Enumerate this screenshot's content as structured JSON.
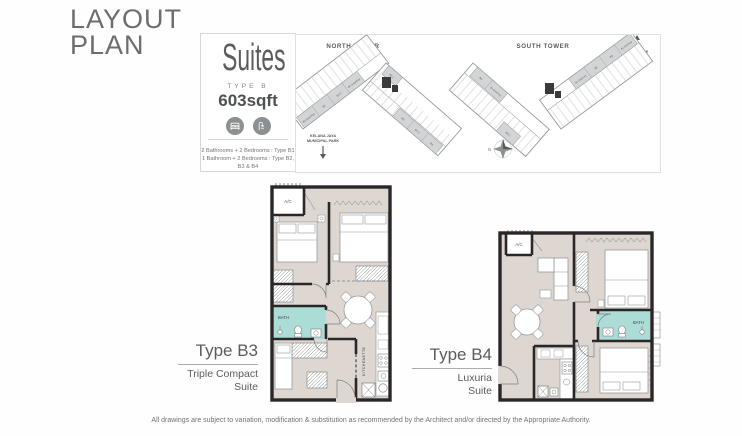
{
  "header": {
    "title_line1": "LAYOUT",
    "title_line2": "PLAN"
  },
  "suites_card": {
    "title": "Suites",
    "type_label": "TYPE B",
    "area": "603sqft",
    "icon_names": [
      "bed-icon",
      "shower-icon"
    ],
    "config_line1": "2 Bathrooms + 2 Bedrooms : Type B1",
    "config_line2": "1 Bathroom + 2 Bedrooms : Type B2, B3 & B4"
  },
  "site_plan": {
    "north_tower_label": "NORTH TOWER",
    "south_tower_label": "SOUTH TOWER",
    "skyline_label_line1": "KL SKYLINE",
    "skyline_label_line2": "VIEW",
    "park_label_line1": "KELANA JAYA",
    "park_label_line2": "MUNICIPAL PARK",
    "compass_label": "N",
    "north_tower_units": [
      "B1 Dual Key",
      "B2",
      "B7-2",
      "B7 Dual Key",
      "B4-2",
      "B3",
      "B7-2",
      "B4"
    ],
    "south_tower_units": [
      "B4",
      "B1 Dual Key",
      "B4-2",
      "B1 Dual Key",
      "B2",
      "B3",
      "B1 Dual Key"
    ]
  },
  "unit_b3": {
    "title": "Type B3",
    "subtitle_line1": "Triple Compact",
    "subtitle_line2": "Suite",
    "room_labels": {
      "ac": "A/C",
      "bath": "BATH",
      "kitchenette": "KITCHENETTE"
    }
  },
  "unit_b4": {
    "title": "Type B4",
    "subtitle_line1": "Luxuria",
    "subtitle_line2": "Suite",
    "room_labels": {
      "ac": "A/C",
      "bath": "BATH"
    }
  },
  "footer": {
    "disclaimer": "All drawings are subject to variation, modification & substitution as recommended by the Architect and/or directed by the Appropriate Authority."
  },
  "colors": {
    "text_gray": "#6b6d6f",
    "wall_black": "#2b2728",
    "floor_beige": "#ded7d1",
    "bath_teal": "#abdcd6",
    "shaded_unit_gray": "#d3d4d6",
    "plan_line_gray": "#97999b"
  }
}
